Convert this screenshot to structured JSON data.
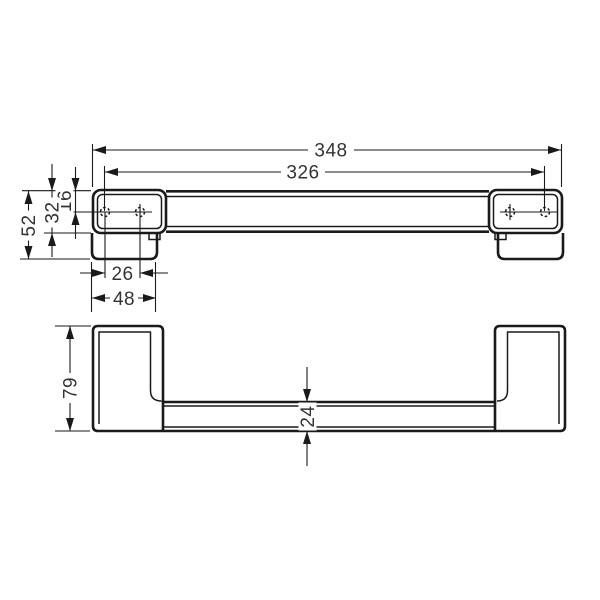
{
  "colors": {
    "background": "#ffffff",
    "line": "#1a1a1a",
    "text": "#333333"
  },
  "views": {
    "top": {
      "label": "top-view",
      "dimensions": {
        "overall_length": "348",
        "hole_span": "326",
        "wall_offset": "52",
        "plate_depth": "32",
        "hole_offset": "16",
        "hole_spacing": "26",
        "foot_width": "48"
      }
    },
    "front": {
      "label": "front-view",
      "dimensions": {
        "overall_height": "79",
        "bar_height": "24"
      }
    }
  }
}
